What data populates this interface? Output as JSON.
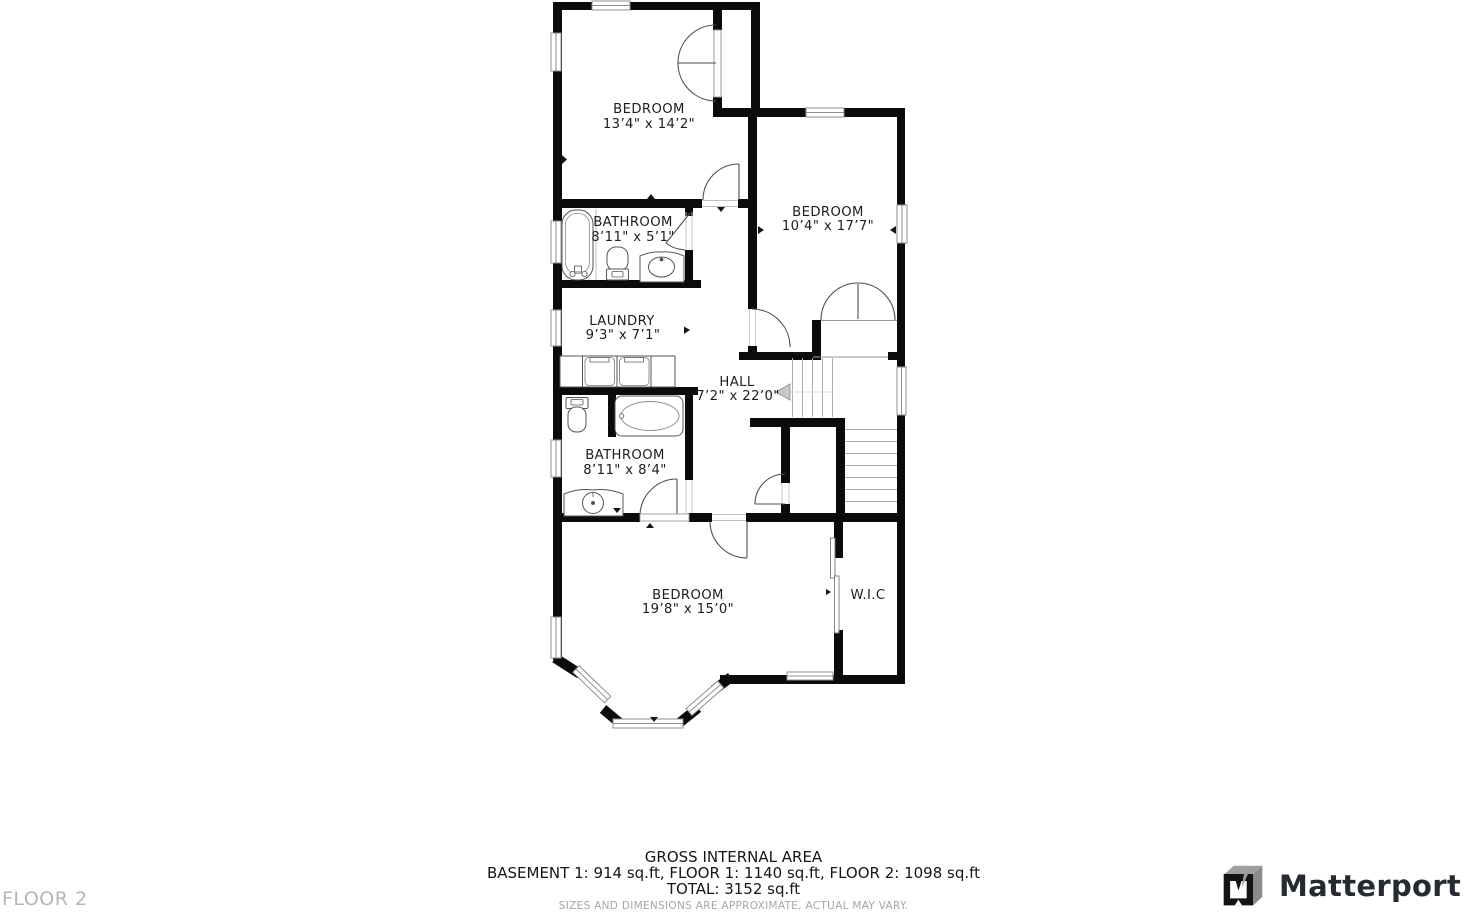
{
  "floor_label": "FLOOR 2",
  "rooms": {
    "bedroom_top": {
      "name": "BEDROOM",
      "dims": "13’4\" x 14’2\""
    },
    "bedroom_right": {
      "name": "BEDROOM",
      "dims": "10’4\" x 17’7\""
    },
    "bathroom_top": {
      "name": "BATHROOM",
      "dims": "8’11\" x 5’1\""
    },
    "laundry": {
      "name": "LAUNDRY",
      "dims": "9’3\" x 7’1\""
    },
    "hall": {
      "name": "HALL",
      "dims": "7’2\" x 22’0\""
    },
    "bathroom_bottom": {
      "name": "BATHROOM",
      "dims": "8’11\" x 8’4\""
    },
    "bedroom_bottom": {
      "name": "BEDROOM",
      "dims": "19’8\" x 15’0\""
    },
    "wic": {
      "name": "W.I.C"
    }
  },
  "footer": {
    "title": "GROSS INTERNAL AREA",
    "breakdown": "BASEMENT 1: 914 sq.ft, FLOOR 1: 1140 sq.ft, FLOOR 2: 1098 sq.ft",
    "total": "TOTAL: 3152 sq.ft",
    "disclaimer": "SIZES AND DIMENSIONS ARE APPROXIMATE, ACTUAL MAY VARY."
  },
  "brand": {
    "name": "Matterport",
    "icon": "matterport-cube-icon"
  },
  "colors": {
    "wall": "#0b0b0b",
    "fixture_line": "#4f4f4f",
    "window_border": "#8f8f8f",
    "stair_tread": "#adadad",
    "label_text": "#1d1d1d",
    "muted_text": "#a5a5a5",
    "floor_label_text": "#b5b5b5",
    "brand_text": "#262b33"
  }
}
